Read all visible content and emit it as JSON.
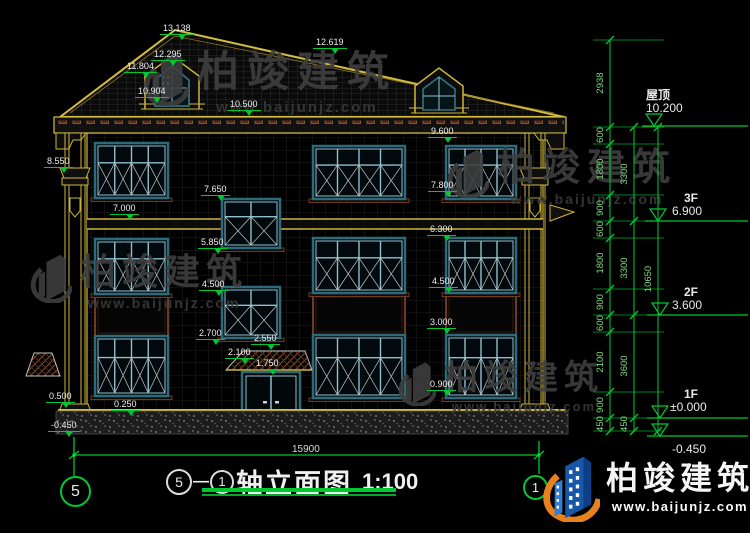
{
  "watermark": {
    "cn": "柏竣建筑",
    "url": "www.baijunjz.com"
  },
  "brand": {
    "cn": "柏竣建筑",
    "url": "www.baijunjz.com"
  },
  "title": {
    "axis_start": "5",
    "dash": "—",
    "axis_end": "1",
    "name": "轴立面图",
    "scale": "1:100"
  },
  "axis_bubbles": {
    "left": "5",
    "right": "1"
  },
  "dims": {
    "overall_width": "15900",
    "outer": "10650",
    "inner": [
      "2938",
      "600",
      "1800",
      "900",
      "600",
      "1800",
      "900",
      "600",
      "2100",
      "900",
      "450"
    ],
    "mid": [
      "3300",
      "3300",
      "3600",
      "450"
    ]
  },
  "levels": [
    {
      "name": "屋顶",
      "elev": "10.200"
    },
    {
      "name": "3F",
      "elev": "6.900"
    },
    {
      "name": "2F",
      "elev": "3.600"
    },
    {
      "name": "1F",
      "elev": "±0.000"
    },
    {
      "name": "",
      "elev": "-0.450"
    }
  ],
  "elev_labels": {
    "peak": "13.138",
    "right_ridge": "12.619",
    "dormer_top": "12.295",
    "dormer_eave": "11.804",
    "dormer_sill": "10.904",
    "main_eave": "10.500",
    "f3_head": "9.600",
    "left_bracket": "8.550",
    "f3_sill": "7.800",
    "stair_up_head": "7.650",
    "f3_floor_edge": "7.000",
    "f2_head": "6.300",
    "stair_up_sill": "5.850",
    "stair_low_head": "4.500",
    "f2_sill": "4.500",
    "f1_head": "3.000",
    "stair_low_sill": "2.700",
    "canopy_high": "2.550",
    "canopy_low": "2.100",
    "door_head": "1.750",
    "f1_sill": "0.900",
    "plinth_top": "0.500",
    "plinth_step": "0.250",
    "ground": "-0.450"
  }
}
